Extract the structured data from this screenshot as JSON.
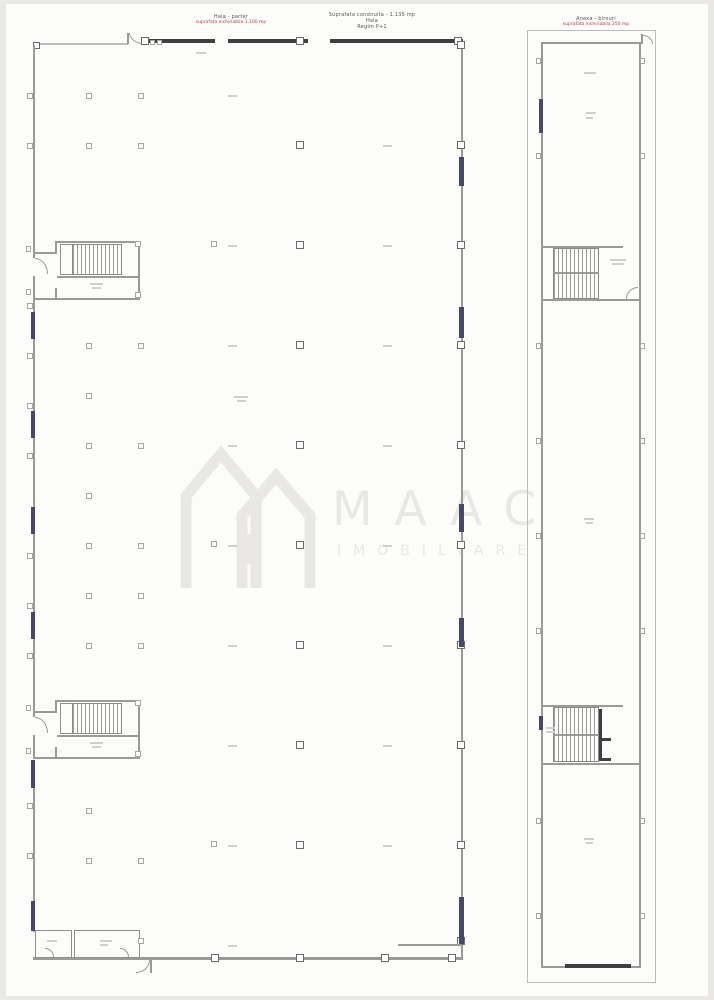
{
  "document": {
    "kind": "real-estate floor plan drawing",
    "buildings": [
      "main hall (left)",
      "narrow annex hall (right)"
    ]
  },
  "colors": {
    "window_navy": "#474769",
    "red_text": "#b34040",
    "watermark": "#eae8e5",
    "wall": "#9a9a98",
    "wall_dark": "#3f3f3f"
  },
  "left_plan": {
    "title_block_1": {
      "line1": "Hala - parter",
      "line2_red": "suprafata inchiriabila 1.100 mp"
    },
    "title_block_2": {
      "line1": "Suprafata construita - 1.135 mp",
      "line2": "Hala",
      "line3": "Regim P+1"
    }
  },
  "right_plan": {
    "title_block": {
      "line1": "Anexa - birouri",
      "line2_red": "suprafata inchiriabila 250 mp"
    }
  },
  "watermark": {
    "brand": "MAAC",
    "subtitle": "IMOBILIARE"
  }
}
